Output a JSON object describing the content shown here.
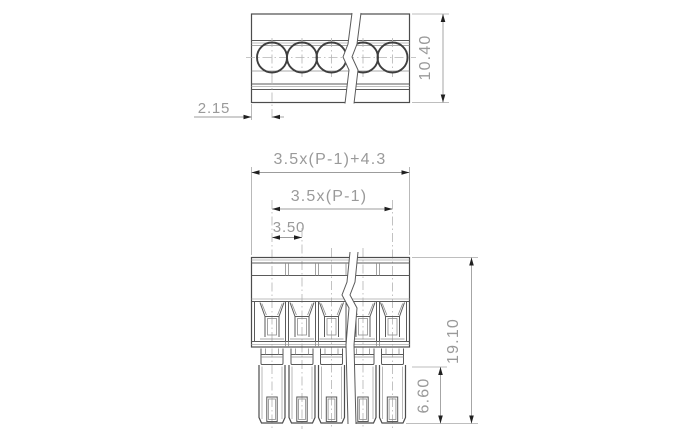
{
  "drawing": {
    "type": "technical-dimension-drawing",
    "part": "pluggable terminal block, 5 positions shown with break lines",
    "positions_visible": 5,
    "views": {
      "top_view": {
        "label": "top-view-screw-side"
      },
      "front_view": {
        "label": "front-view-plug-side"
      }
    },
    "dimensions": {
      "screw_center_offset": "2.15",
      "top_view_depth": "10.40",
      "overall_width_formula": "3.5x(P-1)+4.3",
      "pole_span_formula": "3.5x(P-1)",
      "pitch": "3.50",
      "overall_height": "19.10",
      "pin_length": "6.60"
    }
  }
}
